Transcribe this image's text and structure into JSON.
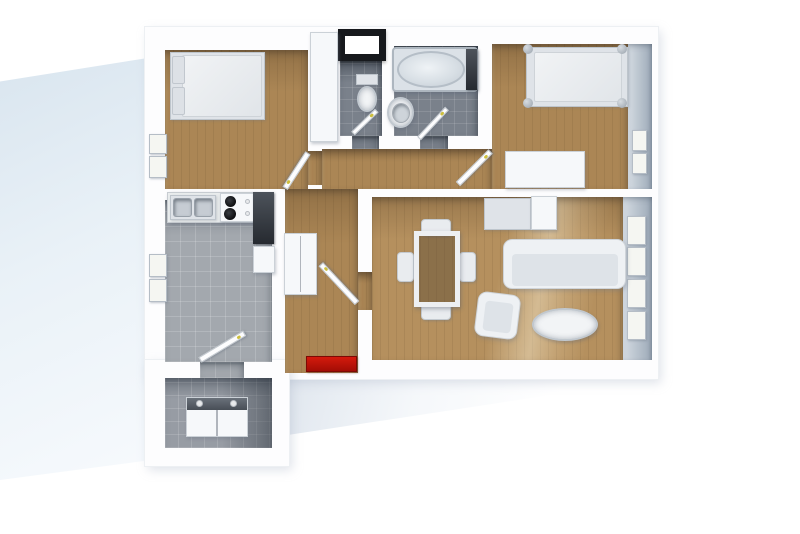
{
  "meta": {
    "title": "3D rendered apartment floor plan, top-down view",
    "style": "architectural render, white walls, no visible text"
  },
  "colors": {
    "background": "#ffffff",
    "walls": "#fdfdfe",
    "wood_floor": "#ab8655",
    "wood_floor_living": "#b5905e",
    "kitchen_tile": "#a3a8ae",
    "bathroom_tile": "#7a818b",
    "laundry_tile": "#979ca4",
    "doormat_red": "#c0140a",
    "window_frame_black": "#17191d",
    "exterior_panel_blue": "#d9e5ef"
  },
  "rooms": [
    {
      "name": "bedroom-1",
      "floor": "wood",
      "furniture": [
        "double-bed",
        "left-wall-windows"
      ]
    },
    {
      "name": "wc",
      "floor": "dark-tile",
      "furniture": [
        "toilet",
        "black-framed-window"
      ]
    },
    {
      "name": "bathroom",
      "floor": "dark-tile",
      "furniture": [
        "bathtub",
        "sink"
      ]
    },
    {
      "name": "bedroom-2",
      "floor": "wood",
      "furniture": [
        "single-bed-with-posts",
        "dresser",
        "right-wall-windows"
      ]
    },
    {
      "name": "kitchen",
      "floor": "light-tile",
      "furniture": [
        "counter-with-double-sink",
        "stove-4-burners",
        "dark-worktop",
        "appliance"
      ]
    },
    {
      "name": "hallway",
      "floor": "wood",
      "furniture": [
        "closet",
        "red-doormat"
      ]
    },
    {
      "name": "living-dining-room",
      "floor": "wood",
      "furniture": [
        "sideboard",
        "dining-table-glass",
        "four-chairs",
        "sofa",
        "armchair",
        "oval-coffee-table",
        "right-wall-windows"
      ]
    },
    {
      "name": "laundry-room",
      "floor": "mid-tile",
      "furniture": [
        "washer-dryer-unit"
      ]
    }
  ],
  "elements": [
    {
      "name": "exterior-panel",
      "kind": "panel",
      "x": 0,
      "y": 56,
      "w": 147,
      "h": 424
    },
    {
      "name": "ground-shadow",
      "kind": "gshadow",
      "x": 284,
      "y": 379,
      "w": 372,
      "h": 56
    },
    {
      "name": "shell-main",
      "kind": "shell",
      "x": 145,
      "y": 27,
      "w": 513,
      "h": 352
    },
    {
      "name": "shell-lower-left",
      "kind": "shell",
      "x": 145,
      "y": 360,
      "w": 144,
      "h": 106
    },
    {
      "name": "bedroom1-floor",
      "kind": "wood",
      "x": 165,
      "y": 50,
      "w": 143,
      "h": 139
    },
    {
      "name": "wc-floor",
      "kind": "tiled",
      "x": 340,
      "y": 60,
      "w": 42,
      "h": 76
    },
    {
      "name": "bathroom-floor",
      "kind": "tiled",
      "x": 394,
      "y": 46,
      "w": 84,
      "h": 90
    },
    {
      "name": "bedroom2-floor",
      "kind": "wood",
      "x": 492,
      "y": 44,
      "w": 136,
      "h": 145
    },
    {
      "name": "bedroom2-right-wall-face",
      "kind": "wallface",
      "x": 628,
      "y": 44,
      "w": 24,
      "h": 145
    },
    {
      "name": "corridor-floor",
      "kind": "wood",
      "x": 322,
      "y": 149,
      "w": 170,
      "h": 40
    },
    {
      "name": "bedroom1-doorway",
      "kind": "wood",
      "x": 308,
      "y": 151,
      "w": 14,
      "h": 34
    },
    {
      "name": "hallway-floor",
      "kind": "wood",
      "x": 285,
      "y": 189,
      "w": 73,
      "h": 184
    },
    {
      "name": "living-doorway",
      "kind": "wood",
      "x": 358,
      "y": 272,
      "w": 14,
      "h": 38
    },
    {
      "name": "kitchen-floor",
      "kind": "tile",
      "x": 165,
      "y": 200,
      "w": 107,
      "h": 162
    },
    {
      "name": "wc-doorway",
      "kind": "tiled",
      "x": 352,
      "y": 136,
      "w": 27,
      "h": 13
    },
    {
      "name": "bathroom-doorway",
      "kind": "tiled",
      "x": 420,
      "y": 136,
      "w": 28,
      "h": 13
    },
    {
      "name": "laundry-doorway",
      "kind": "tile",
      "x": 200,
      "y": 362,
      "w": 44,
      "h": 16
    },
    {
      "name": "living-floor",
      "kind": "wood2",
      "x": 372,
      "y": 197,
      "w": 251,
      "h": 163
    },
    {
      "name": "living-right-wall-face",
      "kind": "wallface",
      "x": 623,
      "y": 197,
      "w": 29,
      "h": 163
    },
    {
      "name": "laundry-floor",
      "kind": "tilem",
      "x": 165,
      "y": 378,
      "w": 107,
      "h": 70
    },
    {
      "name": "laundry-shadow",
      "kind": "shade",
      "x": 222,
      "y": 378,
      "w": 50,
      "h": 70
    },
    {
      "name": "bedroom1-window-pane-1",
      "kind": "pane",
      "x": 149,
      "y": 134,
      "w": 18,
      "h": 20
    },
    {
      "name": "bedroom1-window-pane-2",
      "kind": "pane",
      "x": 149,
      "y": 156,
      "w": 18,
      "h": 22
    },
    {
      "name": "kitchen-window-pane-1",
      "kind": "pane",
      "x": 149,
      "y": 254,
      "w": 18,
      "h": 23
    },
    {
      "name": "kitchen-window-pane-2",
      "kind": "pane",
      "x": 149,
      "y": 279,
      "w": 18,
      "h": 23
    },
    {
      "name": "bedroom2-window-pane-1",
      "kind": "pane",
      "x": 632,
      "y": 130,
      "w": 15,
      "h": 21
    },
    {
      "name": "bedroom2-window-pane-2",
      "kind": "pane",
      "x": 632,
      "y": 153,
      "w": 15,
      "h": 21
    },
    {
      "name": "living-window-pane-1",
      "kind": "pane",
      "x": 627,
      "y": 216,
      "w": 19,
      "h": 29
    },
    {
      "name": "living-window-pane-2",
      "kind": "pane",
      "x": 627,
      "y": 247,
      "w": 19,
      "h": 29
    },
    {
      "name": "living-window-pane-3",
      "kind": "pane",
      "x": 627,
      "y": 279,
      "w": 19,
      "h": 29
    },
    {
      "name": "living-window-pane-4",
      "kind": "pane",
      "x": 627,
      "y": 311,
      "w": 19,
      "h": 29
    },
    {
      "name": "wc-window-black-frame",
      "kind": "winframe",
      "x": 338,
      "y": 29,
      "w": 48,
      "h": 32
    },
    {
      "name": "wall-closet",
      "kind": "wbox",
      "x": 310,
      "y": 32,
      "w": 28,
      "h": 110
    },
    {
      "name": "bed1-frame",
      "kind": "gbox",
      "x": 170,
      "y": 52,
      "w": 95,
      "h": 68
    },
    {
      "name": "bed1-mattress",
      "kind": "mattress",
      "x": 182,
      "y": 55,
      "w": 80,
      "h": 62
    },
    {
      "name": "bed1-pillow-1",
      "kind": "pillow",
      "x": 172,
      "y": 56,
      "w": 13,
      "h": 28
    },
    {
      "name": "bed1-pillow-2",
      "kind": "pillow",
      "x": 172,
      "y": 87,
      "w": 13,
      "h": 28
    },
    {
      "name": "toilet-tank",
      "kind": "gbox",
      "x": 356,
      "y": 74,
      "w": 22,
      "h": 11
    },
    {
      "name": "toilet-bowl",
      "kind": "oval",
      "x": 357,
      "y": 86,
      "w": 20,
      "h": 26
    },
    {
      "name": "bathtub",
      "kind": "tub",
      "x": 392,
      "y": 47,
      "w": 86,
      "h": 45
    },
    {
      "name": "bathtub-basin",
      "kind": "tubinner",
      "x": 397,
      "y": 51,
      "w": 68,
      "h": 37
    },
    {
      "name": "bathtub-fixture",
      "kind": "dbox",
      "x": 466,
      "y": 49,
      "w": 11,
      "h": 41
    },
    {
      "name": "bath-sink",
      "kind": "oval",
      "x": 387,
      "y": 97,
      "w": 27,
      "h": 31
    },
    {
      "name": "bath-sink-basin",
      "kind": "basinr",
      "x": 392,
      "y": 103,
      "w": 18,
      "h": 20
    },
    {
      "name": "bed2-frame",
      "kind": "gbox",
      "x": 526,
      "y": 47,
      "w": 102,
      "h": 60
    },
    {
      "name": "bed2-mattress",
      "kind": "mattress",
      "x": 534,
      "y": 52,
      "w": 88,
      "h": 50
    },
    {
      "name": "bed2-post-1",
      "kind": "post",
      "x": 523,
      "y": 44,
      "w": 10,
      "h": 10
    },
    {
      "name": "bed2-post-2",
      "kind": "post",
      "x": 617,
      "y": 44,
      "w": 10,
      "h": 10
    },
    {
      "name": "bed2-post-3",
      "kind": "post",
      "x": 523,
      "y": 98,
      "w": 10,
      "h": 10
    },
    {
      "name": "bed2-post-4",
      "kind": "post",
      "x": 617,
      "y": 98,
      "w": 10,
      "h": 10
    },
    {
      "name": "bedroom2-dresser",
      "kind": "wbox",
      "x": 505,
      "y": 151,
      "w": 80,
      "h": 37
    },
    {
      "name": "sideboard-left",
      "kind": "gbox",
      "x": 484,
      "y": 198,
      "w": 47,
      "h": 32
    },
    {
      "name": "sideboard-right",
      "kind": "wbox",
      "x": 531,
      "y": 196,
      "w": 26,
      "h": 34
    },
    {
      "name": "dining-chair-north",
      "kind": "chair",
      "x": 421,
      "y": 219,
      "w": 30,
      "h": 17
    },
    {
      "name": "dining-chair-south",
      "kind": "chair",
      "x": 421,
      "y": 303,
      "w": 30,
      "h": 17
    },
    {
      "name": "dining-chair-west",
      "kind": "chair",
      "x": 397,
      "y": 252,
      "w": 17,
      "h": 30
    },
    {
      "name": "dining-chair-east",
      "kind": "chair",
      "x": 459,
      "y": 252,
      "w": 17,
      "h": 30
    },
    {
      "name": "dining-table",
      "kind": "glass",
      "x": 414,
      "y": 231,
      "w": 46,
      "h": 76
    },
    {
      "name": "sofa",
      "kind": "sofa",
      "x": 503,
      "y": 239,
      "w": 123,
      "h": 50
    },
    {
      "name": "sofa-seat",
      "kind": "seat",
      "x": 512,
      "y": 254,
      "w": 106,
      "h": 32
    },
    {
      "name": "armchair",
      "kind": "sofa",
      "x": 476,
      "y": 293,
      "w": 43,
      "h": 45,
      "rot": 7
    },
    {
      "name": "armchair-seat",
      "kind": "seat",
      "x": 484,
      "y": 302,
      "w": 28,
      "h": 30,
      "rot": 7
    },
    {
      "name": "coffee-table",
      "kind": "oval",
      "x": 532,
      "y": 308,
      "w": 66,
      "h": 33
    },
    {
      "name": "kitchen-counter",
      "kind": "counter",
      "x": 167,
      "y": 192,
      "w": 88,
      "h": 31
    },
    {
      "name": "kitchen-sink-unit",
      "kind": "gbox",
      "x": 170,
      "y": 195,
      "w": 46,
      "h": 25
    },
    {
      "name": "kitchen-sink-basin-1",
      "kind": "basin",
      "x": 173,
      "y": 198,
      "w": 19,
      "h": 19
    },
    {
      "name": "kitchen-sink-basin-2",
      "kind": "basin",
      "x": 194,
      "y": 198,
      "w": 19,
      "h": 19
    },
    {
      "name": "kitchen-stove",
      "kind": "wbox",
      "x": 220,
      "y": 193,
      "w": 36,
      "h": 29
    },
    {
      "name": "stove-burner-1",
      "kind": "burner",
      "x": 225,
      "y": 196,
      "w": 11,
      "h": 11
    },
    {
      "name": "stove-burner-2",
      "kind": "burner",
      "x": 224,
      "y": 208,
      "w": 12,
      "h": 12
    },
    {
      "name": "stove-knob-1",
      "kind": "knob",
      "x": 245,
      "y": 199,
      "w": 5,
      "h": 5
    },
    {
      "name": "stove-knob-2",
      "kind": "knob",
      "x": 245,
      "y": 211,
      "w": 5,
      "h": 5
    },
    {
      "name": "kitchen-dark-worktop",
      "kind": "dbox",
      "x": 253,
      "y": 192,
      "w": 21,
      "h": 52
    },
    {
      "name": "kitchen-appliance",
      "kind": "wbox",
      "x": 253,
      "y": 246,
      "w": 22,
      "h": 27
    },
    {
      "name": "hall-closet",
      "kind": "wbox",
      "x": 284,
      "y": 233,
      "w": 33,
      "h": 62
    },
    {
      "name": "hall-closet-divider",
      "kind": "vline",
      "x": 300,
      "y": 236,
      "w": 1,
      "h": 56
    },
    {
      "name": "washer-dryer-unit",
      "kind": "wbox",
      "x": 186,
      "y": 397,
      "w": 62,
      "h": 40
    },
    {
      "name": "washer-dryer-top",
      "kind": "dstrip",
      "x": 187,
      "y": 398,
      "w": 60,
      "h": 12
    },
    {
      "name": "washer-top-cap-1",
      "kind": "knob",
      "x": 196,
      "y": 400,
      "w": 7,
      "h": 7
    },
    {
      "name": "washer-top-cap-2",
      "kind": "knob",
      "x": 230,
      "y": 400,
      "w": 7,
      "h": 7
    },
    {
      "name": "washer-dryer-divider",
      "kind": "vline",
      "x": 216,
      "y": 410,
      "w": 2,
      "h": 26
    },
    {
      "name": "entrance-doormat",
      "kind": "mat",
      "x": 306,
      "y": 356,
      "w": 51,
      "h": 16
    },
    {
      "name": "bedroom1-door",
      "kind": "door",
      "x": 308,
      "y": 150,
      "w": 42,
      "h": 6,
      "rot": 123,
      "org": "0 50%"
    },
    {
      "name": "wc-door",
      "kind": "door",
      "x": 353,
      "y": 131,
      "w": 33,
      "h": 5,
      "rot": -44,
      "org": "0 50%"
    },
    {
      "name": "bathroom-door",
      "kind": "door",
      "x": 419,
      "y": 136,
      "w": 41,
      "h": 5,
      "rot": -47,
      "org": "0 50%"
    },
    {
      "name": "bedroom2-door",
      "kind": "door",
      "x": 458,
      "y": 181,
      "w": 46,
      "h": 6,
      "rot": -45,
      "org": "0 50%"
    },
    {
      "name": "living-door",
      "kind": "door",
      "x": 357,
      "y": 300,
      "w": 53,
      "h": 6,
      "rot": -133,
      "org": "0 50%"
    },
    {
      "name": "kitchen-door",
      "kind": "door",
      "x": 200,
      "y": 357,
      "w": 52,
      "h": 6,
      "rot": -31,
      "org": "0 50%"
    }
  ]
}
